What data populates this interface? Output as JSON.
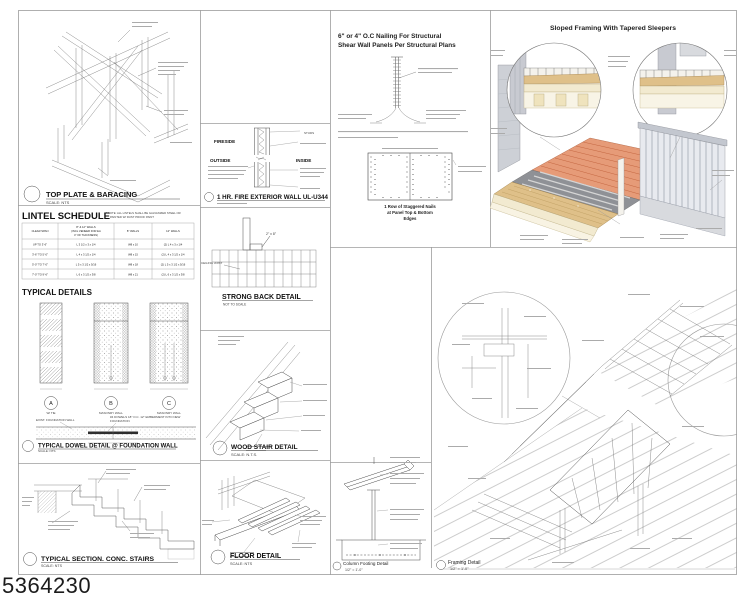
{
  "sheet": {
    "number": "5364230"
  },
  "colors": {
    "tile": "#e69b78",
    "sheathing": "#8f9196",
    "sleeper": "#dfc089",
    "pale": "#f2ead0",
    "wall_gray": "#c8cad1",
    "railing": "#e8eaef",
    "line": "#4a4a4a"
  },
  "top_plate": {
    "title": "TOP PLATE & BARACING",
    "scale": "SCALE: NTS"
  },
  "lintel": {
    "title": "LINTEL SCHEDULE",
    "note1": "* NOTE: ALL LINTELS SHALL BE GALVANIZED STEEL OR",
    "note2": "PAINTED W/ RUST PROOF PAINT",
    "h1": "CLEAR SPAN",
    "h2a": "8\" & 12\" WALLS",
    "h2b": "(INCL VENEER FOR EA",
    "h2c": "4\" OF THICKNESS)",
    "h3": "8\" WALLS",
    "h4": "12\" WALLS",
    "rows": [
      [
        "UP TO 3'-6\"",
        "L 3 1/2 x 3 x 1/4",
        "W8 x 10",
        "(2) L 4 x 3 x 1/4"
      ],
      [
        "3'-6\" TO 5'-0\"",
        "L 4 x 3 1/2 x 1/4",
        "W8 x 15",
        "(2) L 4 x 3 1/2 x 1/4"
      ],
      [
        "5'-0\" TO 7'-0\"",
        "L 5 x 3 1/2 x 5/16",
        "W8 x 18",
        "(2) L 5 x 3 1/2 x 5/16"
      ],
      [
        "7'-0\" TO 9'-6\"",
        "L 6 x 3 1/2 x 3/8",
        "W8 x 21",
        "(2) L 6 x 3 1/2 x 3/8"
      ]
    ]
  },
  "typical": {
    "heading": "TYPICAL DETAILS",
    "a": "A",
    "b": "B",
    "c": "C",
    "a_sub": "W/ TIE",
    "b_sub": "MASONRY WALL",
    "c_sub": "MASONRY WALL",
    "exist": "EXIST. FOUNDATION WALL",
    "dowel1": "#4 DOWELS 18\" O.C. 12\" EMBEDMENT INTO NEW",
    "dowel2": "FOUNDATION",
    "title": "TYPICAL DOWEL DETAIL @ FOUNDATION WALL",
    "scale": "SCALE:      NTS"
  },
  "stairs": {
    "title": "TYPICAL SECTION. CONC. STAIRS",
    "scale": "SCALE:  NTS"
  },
  "firewall": {
    "fireside": "FIRESIDE",
    "outside": "OUTSIDE",
    "inside": "INSIDE",
    "studs": "STUDS",
    "title": "1 HR. FIRE EXTERIOR WALL UL-U344"
  },
  "strongback": {
    "callout": "2\" x 8\"",
    "joist": "CEILING JOIST",
    "title": "STRONG BACK DETAIL",
    "scale": "NOT TO SCALE"
  },
  "woodstair": {
    "title": "WOOD STAIR DETAIL",
    "scale": "SCALE: N.T.S."
  },
  "floor": {
    "title": "FLOOR DETAIL",
    "scale": "SCALE: NTS"
  },
  "shearwall": {
    "title1": "6\" or 4\" O.C Nailing For Structural",
    "title2": "Shear Wall Panels Per Structural Plans",
    "cap1": "1 Row of Staggered Nails",
    "cap2": "at Panel Top & Bottom",
    "cap3": "Edges"
  },
  "sloped": {
    "title": "Sloped Framing With Tapered Sleepers"
  },
  "footing": {
    "title": "Column Footing Detail",
    "scale": "1/2\" = 1'-0\""
  },
  "framing": {
    "title": "Framing Detail",
    "scale": "1/2\" = 1'-0\""
  }
}
